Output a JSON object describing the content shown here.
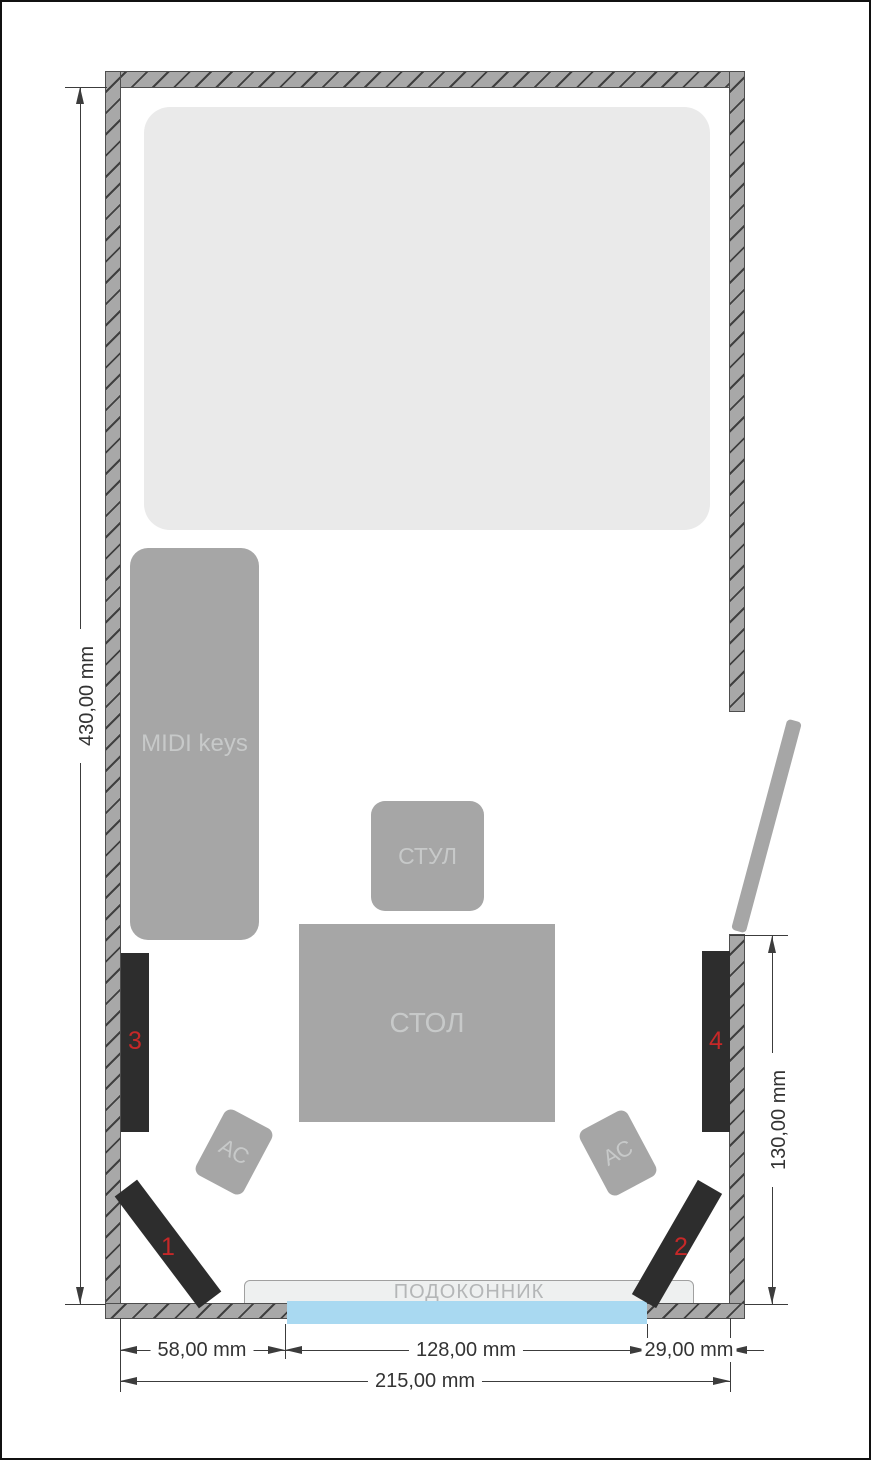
{
  "palette": {
    "wall_fill": "#a8a8a8",
    "wall_hatch": "#3f3f3f",
    "furniture_gray": "#a6a6a6",
    "bed_gray": "#eaeaea",
    "panel_dark": "#2d2d2d",
    "panel_number_red": "#c62828",
    "window_blue": "#a9d9f1",
    "windowsill_gray": "#eef0f0",
    "dimension_color": "#3c3c3c"
  },
  "furniture": {
    "midi_keyboard": {
      "label": "MIDI keys"
    },
    "chair": {
      "label": "СТУЛ"
    },
    "desk": {
      "label": "СТОЛ"
    },
    "speakers": [
      {
        "label": "АС"
      },
      {
        "label": "АС"
      }
    ],
    "windowsill": {
      "label": "ПОДОКОННИК"
    }
  },
  "acoustic_panels": [
    {
      "number": "1"
    },
    {
      "number": "2"
    },
    {
      "number": "3"
    },
    {
      "number": "4"
    }
  ],
  "dimensions": {
    "room_height": "430,00 mm",
    "window_wall_height": "130,00 mm",
    "wall_to_window": "58,00 mm",
    "window_width": "128,00 mm",
    "window_to_wall": "29,00 mm",
    "room_width": "215,00 mm"
  }
}
